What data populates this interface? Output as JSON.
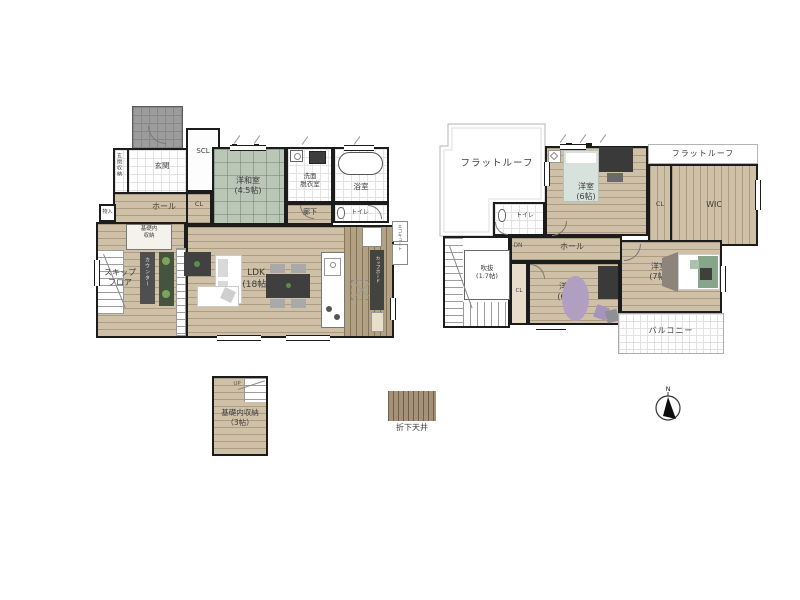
{
  "colors": {
    "wall": "#1c1c1c",
    "wood_floor": "#cfc0a8",
    "tatami_green": "#bac7b7",
    "kitchen_dropped_ceiling": "#b2a283",
    "porch_gray": "#9c9c9c",
    "counter_dark": "#4f4f4f",
    "accent_purple": "#b19fc2",
    "bed_green": "#86a58b",
    "legend_swatch": "#a59079"
  },
  "floor1": {
    "genkan": "玄関",
    "genkan_storage": "玄関収納",
    "scl": "SCL",
    "cl": "CL",
    "mono_ire": "物入",
    "hall": "ホール",
    "washitsu": "洋和室\n(4.5帖)",
    "senmen": "洗面\n脱衣室",
    "bath": "浴室",
    "corridor": "廊下",
    "toilet": "トイレ",
    "kiso_storage": "基礎内\n収納",
    "skip_floor": "スキップ\nフロア",
    "counter": "カウンター",
    "ldk": "LDK\n(18帖)",
    "up": "UP",
    "cupboard": "カップボード",
    "ecocute": "エコキュート"
  },
  "floor2": {
    "flat_roof_left": "フラットルーフ",
    "flat_roof_right": "フラットルーフ",
    "room_a": "洋室\n(6帖)",
    "cl_top": "CL",
    "wic": "WIC",
    "toilet": "トイレ",
    "dn": "DN",
    "hall": "ホール",
    "void": "吹抜\n(1.7帖)",
    "cl_bottom": "CL",
    "room_b": "洋室\n(6帖)",
    "room_c": "洋室\n(7帖)",
    "balcony": "バルコニー"
  },
  "annex": {
    "label": "基礎内収納\n（3帖）",
    "up": "UP"
  },
  "legend": {
    "dropped_ceiling": "折下天井"
  },
  "compass": {
    "north": "N"
  }
}
